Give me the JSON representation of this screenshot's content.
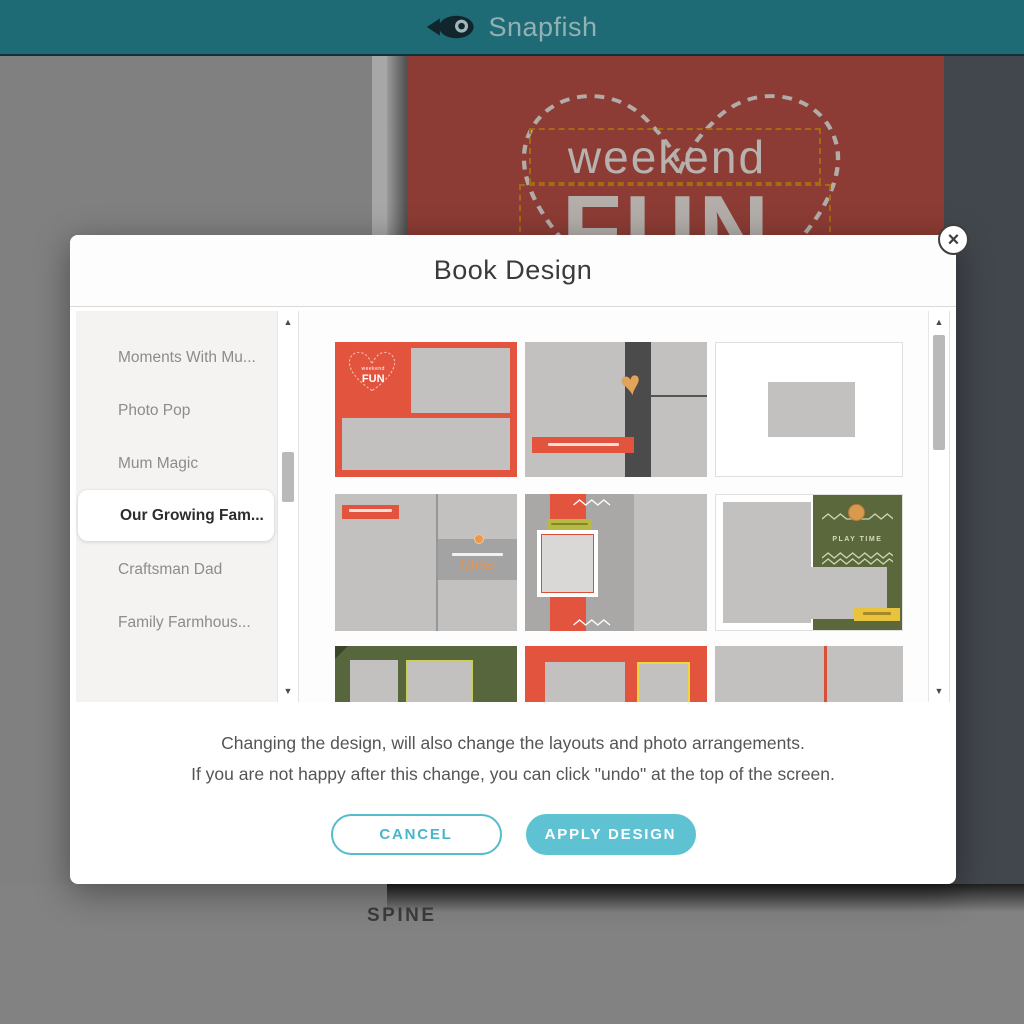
{
  "header": {
    "brand": "Snapfish",
    "logo_icon": "fish-icon"
  },
  "book_cover": {
    "title_top": "weekend",
    "title_main": "FUN"
  },
  "spine_label": "SPINE",
  "icons": {
    "close": "×",
    "arrow_up": "▲",
    "arrow_down": "▼",
    "heart": "♥"
  },
  "modal": {
    "title": "Book Design",
    "design_list": [
      "Moments With Mu...",
      "Photo Pop",
      "Mum Magic",
      "Our Growing Fam...",
      "Bold Type",
      "Craftsman Dad",
      "Family Farmhous..."
    ],
    "selected_design": "Our Growing Fam...",
    "thumbnails": [
      {
        "id": "red-cover-weekend-fun",
        "texts": {
          "small": "weekend",
          "big": "FUN"
        }
      },
      {
        "id": "gray-dark-stripe-heart-banner"
      },
      {
        "id": "white-single-photo"
      },
      {
        "id": "gray-fairies",
        "texts": {
          "caption": "fairies"
        }
      },
      {
        "id": "red-ribbon-photo-frame"
      },
      {
        "id": "olive-play-time",
        "texts": {
          "caption": "PLAY TIME"
        }
      },
      {
        "id": "green-two-photos"
      },
      {
        "id": "red-two-photos"
      },
      {
        "id": "gray-red-divider"
      }
    ],
    "note_line1": "Changing the design, will also change the layouts and photo arrangements.",
    "note_line2": "If you are not happy after this change, you can click \"undo\" at the top of the screen.",
    "cancel_label": "CANCEL",
    "apply_label": "APPLY DESIGN"
  },
  "colors": {
    "header_teal": "#1e6b75",
    "accent_teal": "#5ec2d3",
    "book_red_dimmed": "#8c3c34",
    "thumb_red": "#e2543e",
    "olive_green": "#5a683c",
    "tag_yellow": "#eac33e",
    "workspace_gray": "#808080"
  }
}
